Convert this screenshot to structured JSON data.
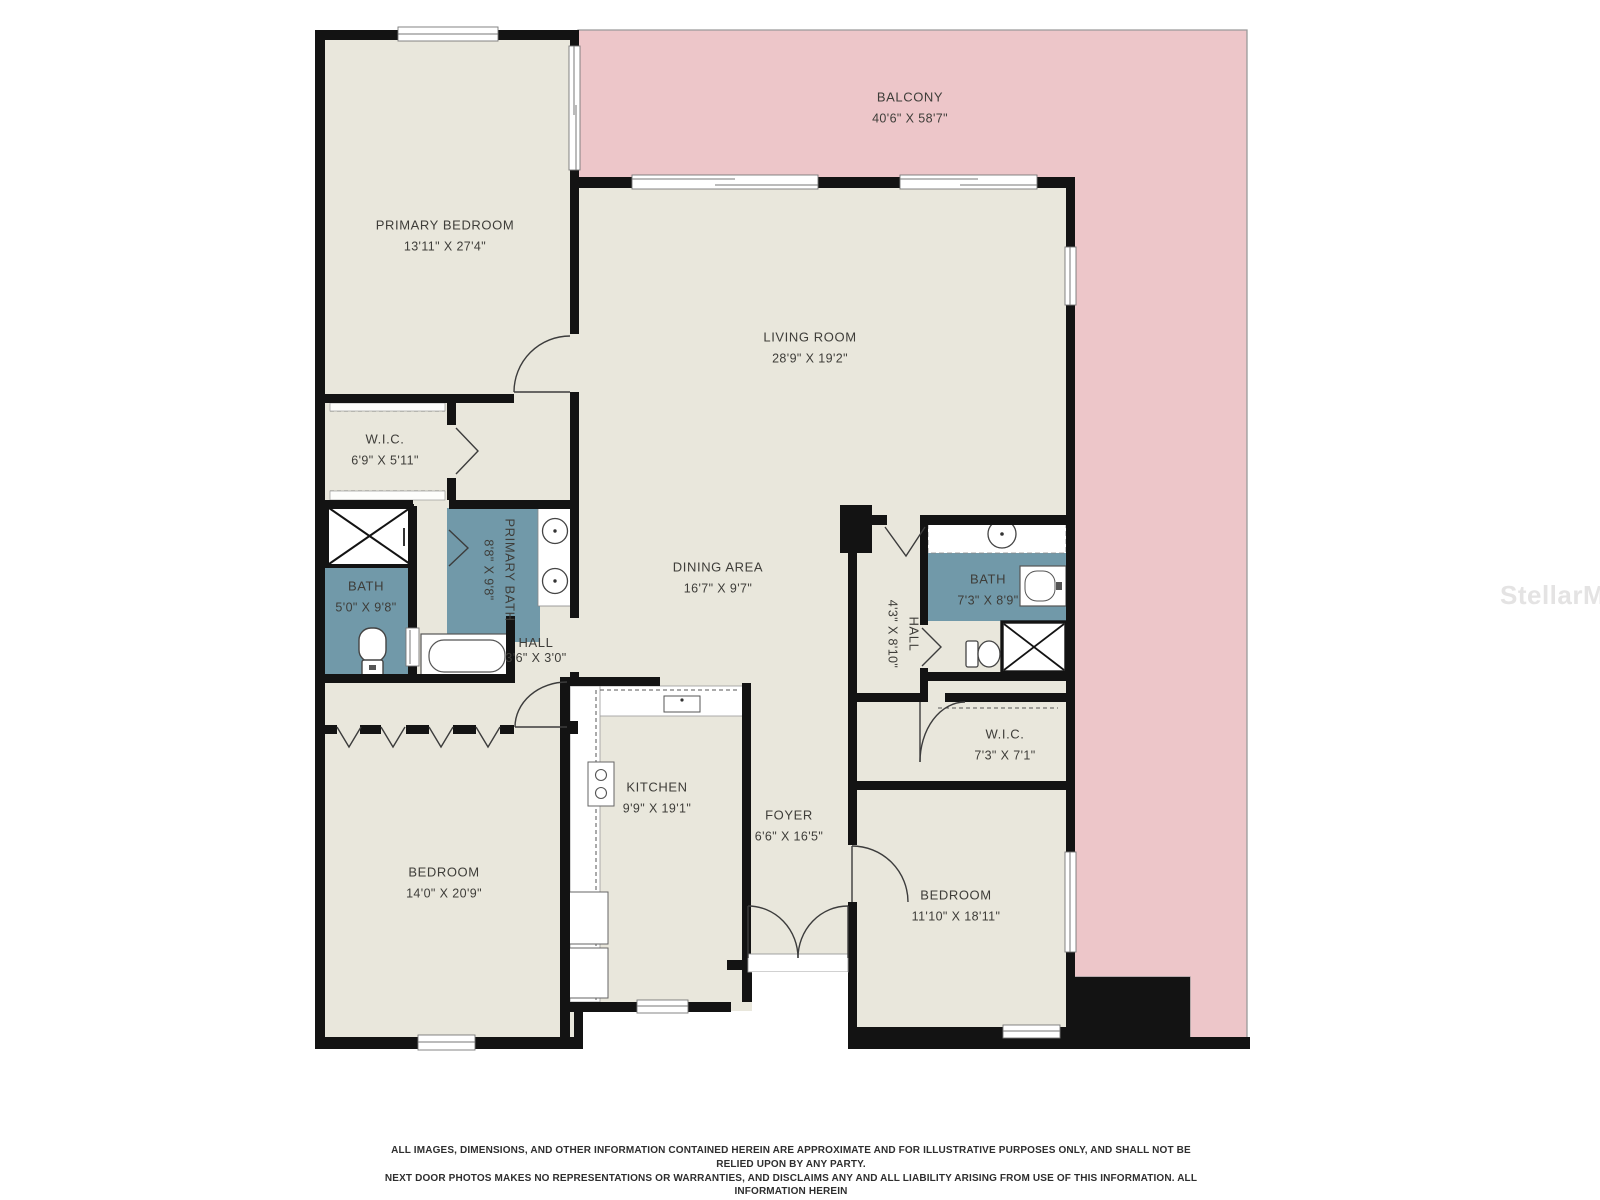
{
  "plan": {
    "rooms": {
      "balcony": {
        "name": "BALCONY",
        "dims": "40'6\" X 58'7\""
      },
      "primary_bedroom": {
        "name": "PRIMARY BEDROOM",
        "dims": "13'11\" X 27'4\""
      },
      "living_room": {
        "name": "LIVING ROOM",
        "dims": "28'9\" X 19'2\""
      },
      "wic_left": {
        "name": "W.I.C.",
        "dims": "6'9\" X 5'11\""
      },
      "bath_left": {
        "name": "BATH",
        "dims": "5'0\" X 9'8\""
      },
      "primary_bath": {
        "name": "PRIMARY BATH",
        "dims": "8'8\" X 9'8\""
      },
      "dining_area": {
        "name": "DINING AREA",
        "dims": "16'7\" X 9'7\""
      },
      "hall_left": {
        "name": "HALL",
        "dims": "3'6\" X 3'0\""
      },
      "hall_right": {
        "name": "HALL",
        "dims": "4'3\" X 8'10\""
      },
      "bath_right": {
        "name": "BATH",
        "dims": "7'3\" X 8'9\""
      },
      "wic_right": {
        "name": "W.I.C.",
        "dims": "7'3\" X 7'1\""
      },
      "kitchen": {
        "name": "KITCHEN",
        "dims": "9'9\" X 19'1\""
      },
      "foyer": {
        "name": "FOYER",
        "dims": "6'6\" X 16'5\""
      },
      "bedroom_left": {
        "name": "BEDROOM",
        "dims": "14'0\" X 20'9\""
      },
      "bedroom_right": {
        "name": "BEDROOM",
        "dims": "11'10\" X 18'11\""
      }
    },
    "watermark": "StellarMLS",
    "colors": {
      "room_fill": "#e9e7dc",
      "balcony_fill": "#edc6c9",
      "bath_fill": "#7199a9",
      "wall": "#131313"
    }
  },
  "disclaimer": {
    "line1": "ALL IMAGES, DIMENSIONS, AND OTHER INFORMATION CONTAINED HEREIN ARE APPROXIMATE AND FOR ILLUSTRATIVE PURPOSES ONLY, AND SHALL NOT BE RELIED UPON BY ANY PARTY.",
    "line2": "NEXT DOOR PHOTOS MAKES NO REPRESENTATIONS OR WARRANTIES, AND DISCLAIMS ANY AND ALL LIABILITY ARISING FROM USE OF THIS INFORMATION. ALL INFORMATION HEREIN",
    "line3": "SHALL BE SUBJECT TO THE TERMS AND CONDITIONS FOUND AT NEXTDOORPHOTOS.COM/TC."
  }
}
